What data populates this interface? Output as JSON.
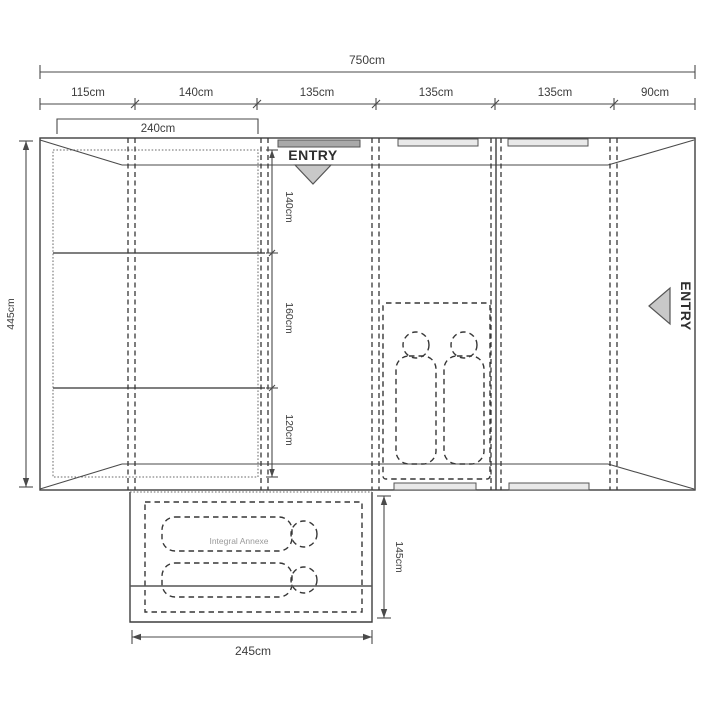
{
  "dims": {
    "overall_width": "750cm",
    "top_sections": [
      "115cm",
      "140cm",
      "135cm",
      "135cm",
      "135cm",
      "90cm"
    ],
    "bedroom_width": "240cm",
    "overall_depth": "445cm",
    "bedroom_sections": [
      "140cm",
      "160cm",
      "120cm"
    ],
    "annexe_width": "245cm",
    "annexe_depth": "145cm"
  },
  "labels": {
    "entry": "ENTRY",
    "integral_annexe": "Integral Annexe"
  },
  "colors": {
    "line": "#3f3f3f",
    "bedroom_fill": "#d7d7d7",
    "sleeping_bag_fill": "#ffffff",
    "entry_arrow_fill": "#c8c8c8",
    "door_dark": "#a9a9a9",
    "door_light": "#e9e9e9",
    "annexe_label": "#9a9a9a"
  }
}
